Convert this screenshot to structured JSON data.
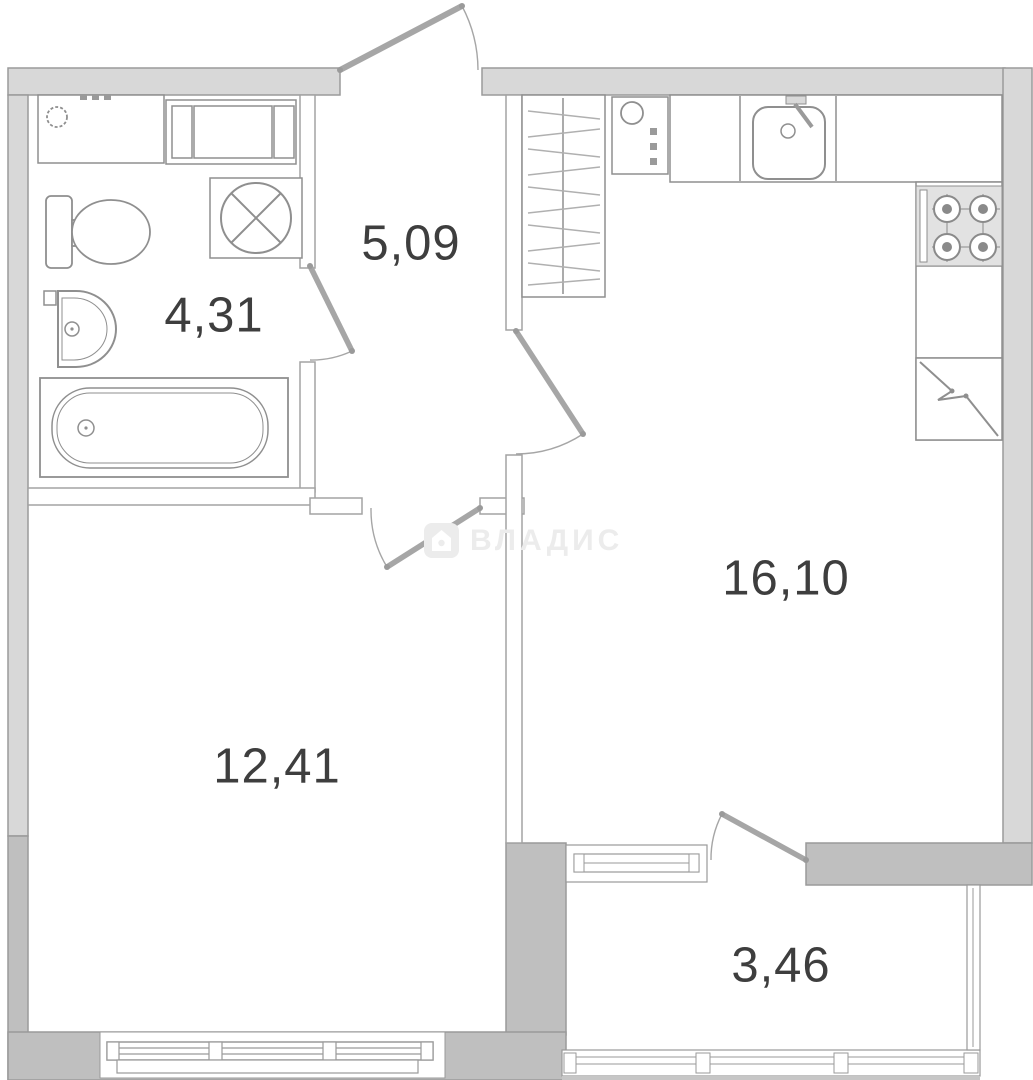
{
  "plan": {
    "watermark": {
      "text": "ВЛАДИС",
      "icon": "house-badge-icon"
    },
    "rooms": [
      {
        "name": "hallway",
        "area_label": "5,09"
      },
      {
        "name": "bathroom",
        "area_label": "4,31"
      },
      {
        "name": "kitchen-living-room",
        "area_label": "16,10"
      },
      {
        "name": "room",
        "area_label": "12,41"
      },
      {
        "name": "balcony",
        "area_label": "3,46"
      }
    ],
    "fixtures": [
      "bathroom-counter",
      "washing-machine",
      "ventilation-fan",
      "toilet",
      "wash-basin",
      "bathtub",
      "wardrobe",
      "water-heater",
      "kitchen-counter",
      "kitchen-sink",
      "stove",
      "refrigerator"
    ],
    "colors": {
      "outer_wall": "#d8d8d8",
      "load_bearing_wall": "#bfbfbf",
      "wall_stroke": "#9a9a9a",
      "interior_wall_stroke": "#a3a3a3",
      "fixture_stroke": "#8f8f8f",
      "door_swing": "#a6a6a6",
      "label_text": "#3e3e3e",
      "watermark": "#ececec"
    }
  }
}
